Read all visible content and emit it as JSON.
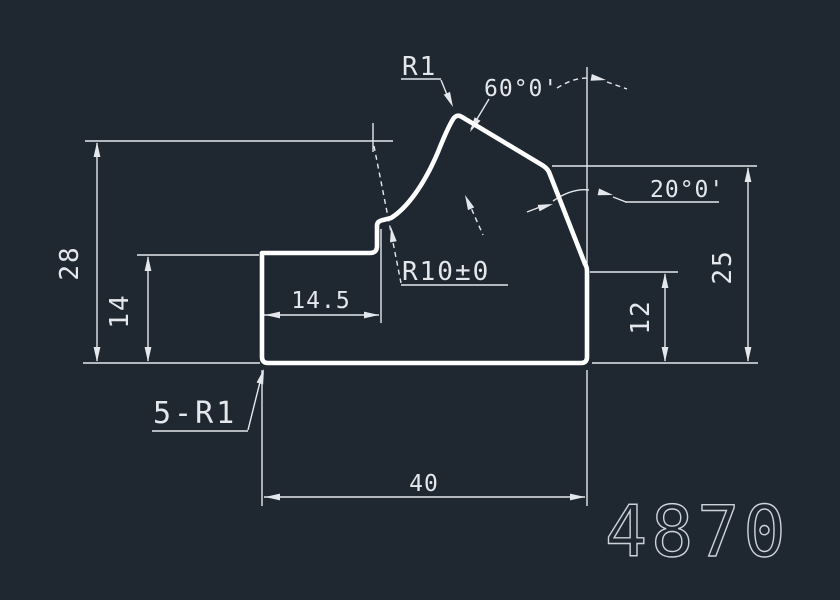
{
  "canvas": {
    "background": "#1f2730",
    "line": "#ffffff",
    "thin": "#e4e8ed",
    "title_color": "#ccd2da"
  },
  "title_block": {
    "drawing_number": "4870"
  },
  "annotations": {
    "peak_radius": "R1",
    "top_angle": "60°0'",
    "right_angle": "20°0'",
    "mid_radius": "R10±0",
    "corner_radii_note": "5-R1"
  },
  "dimensions": {
    "overall_height": "28",
    "step_height": "14",
    "step_width": "14.5",
    "right_height": "25",
    "right_lower_height": "12",
    "overall_width": "40"
  }
}
